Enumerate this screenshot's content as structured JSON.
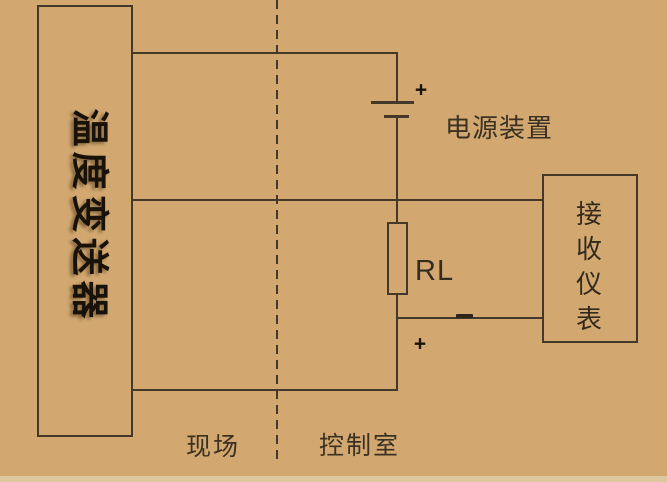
{
  "diagram": {
    "transmitter": {
      "label": "温度变送器"
    },
    "power_supply": {
      "label": "电源装置"
    },
    "receiver": {
      "label": "接收仪表"
    },
    "load_resistor": {
      "label": "RL"
    },
    "zones": {
      "field": "现场",
      "control_room": "控制室"
    },
    "polarity": {
      "battery_plus": "+",
      "loop_plus": "+"
    }
  },
  "colors": {
    "background": "#d2a870",
    "line": "#43382a",
    "text": "#332a1d",
    "dark_text": "#181208",
    "bottom_strip": "#dcc79f"
  }
}
